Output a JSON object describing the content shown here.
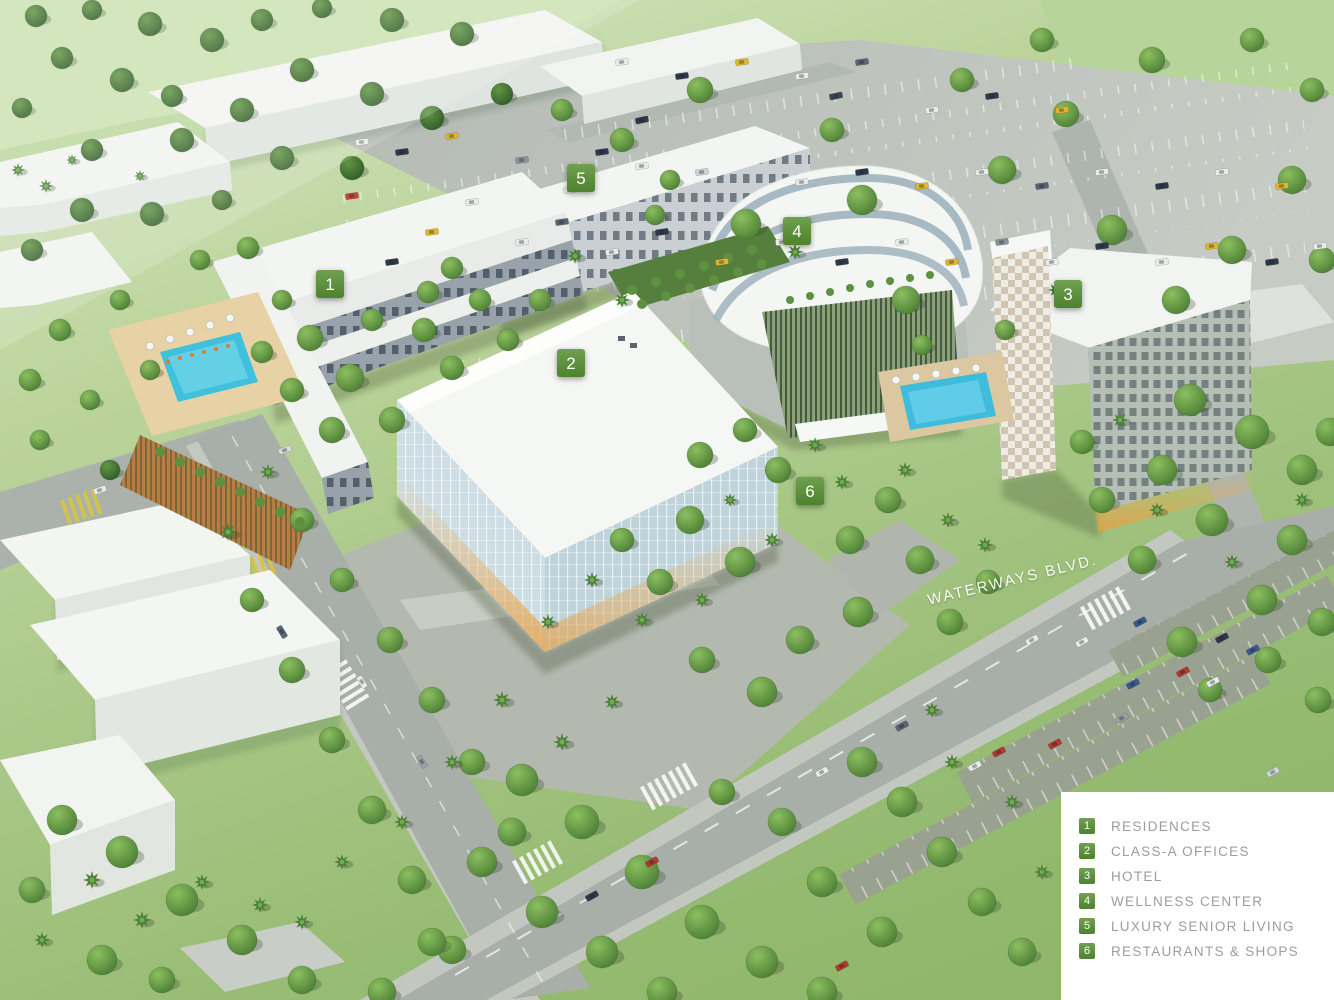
{
  "scene": {
    "street_label": "WATERWAYS BLVD.",
    "marker_color": "#579133",
    "markers": [
      {
        "number": "1",
        "x": 330,
        "y": 284
      },
      {
        "number": "2",
        "x": 571,
        "y": 363
      },
      {
        "number": "3",
        "x": 1068,
        "y": 294
      },
      {
        "number": "4",
        "x": 797,
        "y": 231
      },
      {
        "number": "5",
        "x": 581,
        "y": 178
      },
      {
        "number": "6",
        "x": 810,
        "y": 491
      }
    ]
  },
  "legend": {
    "background": "#ffffff",
    "text_color": "#9a9da0",
    "items": [
      {
        "number": "1",
        "label": "RESIDENCES"
      },
      {
        "number": "2",
        "label": "CLASS-A OFFICES"
      },
      {
        "number": "3",
        "label": "HOTEL"
      },
      {
        "number": "4",
        "label": "WELLNESS CENTER"
      },
      {
        "number": "5",
        "label": "LUXURY SENIOR LIVING"
      },
      {
        "number": "6",
        "label": "RESTAURANTS & SHOPS"
      }
    ]
  }
}
